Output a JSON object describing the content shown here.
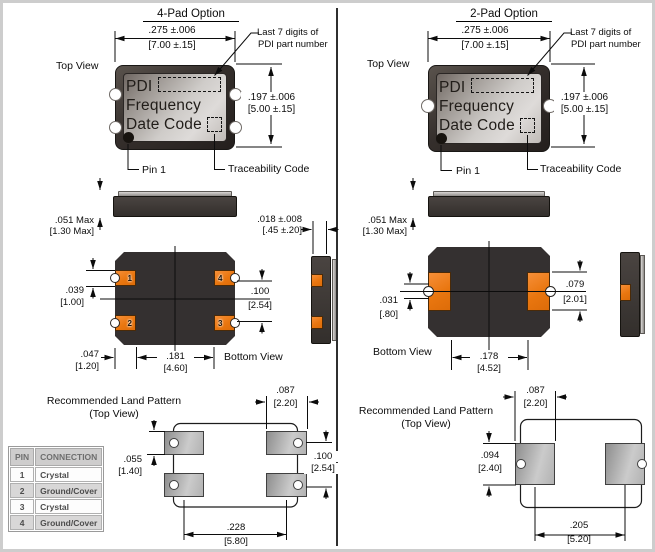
{
  "colors": {
    "pad_orange": "#ee7c1f",
    "package_dark": "#37322f",
    "land_pad_gray": "#b3b3b3",
    "line": "#0c0c0c"
  },
  "left": {
    "title": "4-Pad Option",
    "top_view_label": "Top View",
    "last7_l1": "Last 7 digits of",
    "last7_l2": "PDI part number",
    "pkg_l1": "PDI",
    "pkg_l2": "Frequency",
    "pkg_l3": "Date Code",
    "pin1_label": "Pin 1",
    "trace_label": "Traceability Code",
    "dim_width_in": ".275 ±.006",
    "dim_width_mm": "[7.00 ±.15]",
    "dim_height_in": ".197 ±.006",
    "dim_height_mm": "[5.00 ±.15]",
    "dim_thick_in": ".051 Max",
    "dim_thick_mm": "[1.30 Max]",
    "dim_cast_in": ".018 ±.008",
    "dim_cast_mm": "[.45 ±.20]",
    "dim_pad_in": ".039",
    "dim_pad_mm": "[1.00]",
    "dim_pitch_in": ".100",
    "dim_pitch_mm": "[2.54]",
    "dim_edge_in": ".047",
    "dim_edge_mm": "[1.20]",
    "dim_span_in": ".181",
    "dim_span_mm": "[4.60]",
    "bottom_view_label": "Bottom View",
    "land_l1": "Recommended Land Pattern",
    "land_l2": "(Top View)",
    "dim_land_w_in": ".087",
    "dim_land_w_mm": "[2.20]",
    "dim_land_h_in": ".055",
    "dim_land_h_mm": "[1.40]",
    "dim_land_pitch_in": ".100",
    "dim_land_pitch_mm": "[2.54]",
    "dim_land_span_in": ".228",
    "dim_land_span_mm": "[5.80]",
    "pad1": "1",
    "pad2": "2",
    "pad3": "3",
    "pad4": "4"
  },
  "right": {
    "title": "2-Pad Option",
    "top_view_label": "Top View",
    "last7_l1": "Last 7 digits of",
    "last7_l2": "PDI part number",
    "pkg_l1": "PDI",
    "pkg_l2": "Frequency",
    "pkg_l3": "Date Code",
    "pin1_label": "Pin 1",
    "trace_label": "Traceability Code",
    "dim_width_in": ".275 ±.006",
    "dim_width_mm": "[7.00 ±.15]",
    "dim_height_in": ".197 ±.006",
    "dim_height_mm": "[5.00 ±.15]",
    "dim_thick_in": ".051 Max",
    "dim_thick_mm": "[1.30 Max]",
    "dim_pad_in": ".031",
    "dim_pad_mm": "[.80]",
    "dim_pad_h_in": ".079",
    "dim_pad_h_mm": "[2.01]",
    "dim_span_in": ".178",
    "dim_span_mm": "[4.52]",
    "bottom_view_label": "Bottom View",
    "land_l1": "Recommended Land Pattern",
    "land_l2": "(Top View)",
    "dim_land_w_in": ".087",
    "dim_land_w_mm": "[2.20]",
    "dim_land_h_in": ".094",
    "dim_land_h_mm": "[2.40]",
    "dim_land_span_in": ".205",
    "dim_land_span_mm": "[5.20]"
  },
  "pin_table": {
    "headers": [
      "PIN",
      "CONNECTION"
    ],
    "rows": [
      [
        "1",
        "Crystal"
      ],
      [
        "2",
        "Ground/Cover"
      ],
      [
        "3",
        "Crystal"
      ],
      [
        "4",
        "Ground/Cover"
      ]
    ]
  }
}
